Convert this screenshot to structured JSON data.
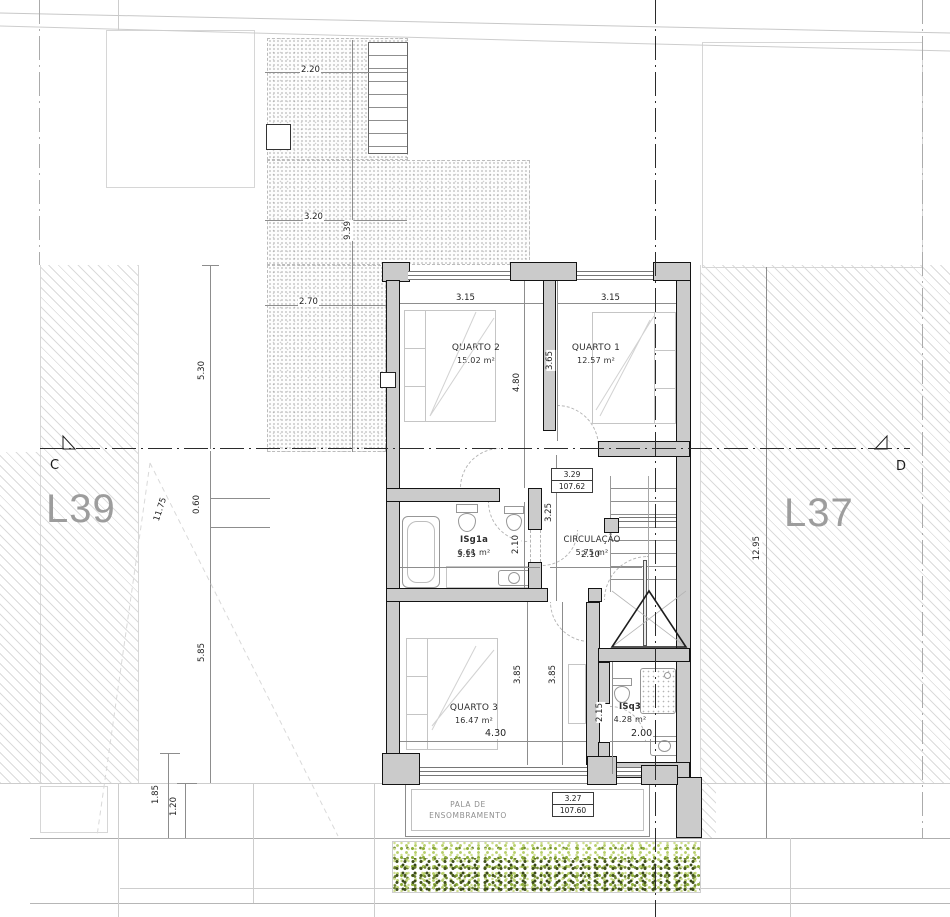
{
  "drawing": {
    "lots": {
      "left": "L39",
      "right": "L37"
    },
    "section_markers": {
      "left": "C",
      "right": "D"
    },
    "rooms": {
      "quarto2": {
        "name": "QUARTO 2",
        "area": "15.02 m²"
      },
      "quarto1": {
        "name": "QUARTO 1",
        "area": "12.57 m²"
      },
      "isg1a": {
        "name": "ISg1a",
        "area": "6.61 m²"
      },
      "circulacao": {
        "name": "CIRCULAÇÃO",
        "area": "5.75 m²"
      },
      "quarto3": {
        "name": "QUARTO 3",
        "area": "16.47 m²"
      },
      "isq3": {
        "name": "ISq3",
        "area": "4.28 m²"
      }
    },
    "levels": {
      "floor": {
        "height": "3.29",
        "elevation": "107.62"
      },
      "porch": {
        "height": "3.27",
        "elevation": "107.60"
      }
    },
    "porch": {
      "line1": "PALA DE",
      "line2": "ENSOMBRAMENTO"
    },
    "dimensions": {
      "court_top": "2.20",
      "court_mid": "3.20",
      "court_depth": "9.39",
      "court_low": "2.70",
      "q2_width": "3.15",
      "q1_width": "3.15",
      "q2_depth": "4.80",
      "q1_depth": "3.65",
      "hall_depth": "3.25",
      "bath_depth": "2.10",
      "bath_width": "3.15",
      "circ_width": "2.10",
      "q3_depth_a": "3.85",
      "q3_depth_b": "3.85",
      "q3_width": "4.30",
      "isq3_depth": "2.15",
      "isq3_width": "2.00",
      "site_left_upper": "5.30",
      "site_left_total": "11.75",
      "site_left_step": "0.60",
      "site_left_lower": "5.85",
      "site_left_porch": "1.85",
      "site_left_porch2": "1.20",
      "site_right": "12.95"
    },
    "colors": {
      "wall_fill": "#cbcbcb",
      "lot_label": "#9d9d9d",
      "hedge_light": "#b8cf6d",
      "hedge_dark": "#42521d"
    }
  }
}
